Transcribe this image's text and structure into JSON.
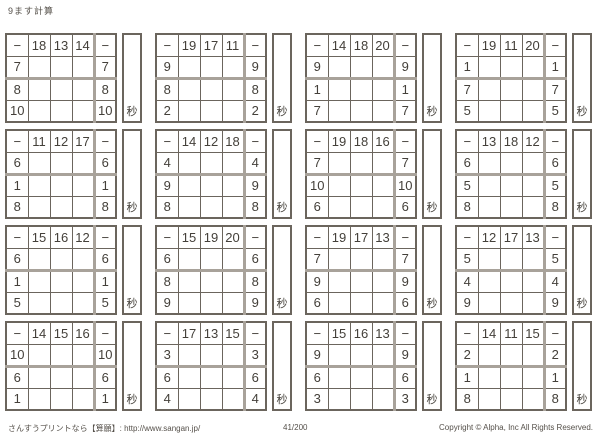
{
  "page": {
    "title": "9ます計算",
    "footer": {
      "site": "さんすうプリントなら【算願】: http://www.sangan.jp/",
      "page_number": "41/200",
      "copyright": "Copyright © Alpha, Inc All Rights Reserved."
    }
  },
  "worksheet": {
    "operator": "−",
    "seconds_label": "秒",
    "grids": [
      {
        "top": [
          "18",
          "13",
          "14"
        ],
        "left": [
          "7",
          "8",
          "10"
        ]
      },
      {
        "top": [
          "19",
          "17",
          "11"
        ],
        "left": [
          "9",
          "8",
          "2"
        ]
      },
      {
        "top": [
          "14",
          "18",
          "20"
        ],
        "left": [
          "9",
          "1",
          "7"
        ]
      },
      {
        "top": [
          "19",
          "11",
          "20"
        ],
        "left": [
          "1",
          "7",
          "5"
        ]
      },
      {
        "top": [
          "11",
          "12",
          "17"
        ],
        "left": [
          "6",
          "1",
          "8"
        ]
      },
      {
        "top": [
          "14",
          "12",
          "18"
        ],
        "left": [
          "4",
          "9",
          "8"
        ]
      },
      {
        "top": [
          "19",
          "18",
          "16"
        ],
        "left": [
          "7",
          "10",
          "6"
        ]
      },
      {
        "top": [
          "13",
          "18",
          "12"
        ],
        "left": [
          "6",
          "5",
          "8"
        ]
      },
      {
        "top": [
          "15",
          "16",
          "12"
        ],
        "left": [
          "6",
          "1",
          "5"
        ]
      },
      {
        "top": [
          "15",
          "19",
          "20"
        ],
        "left": [
          "6",
          "8",
          "9"
        ]
      },
      {
        "top": [
          "19",
          "17",
          "13"
        ],
        "left": [
          "7",
          "9",
          "6"
        ]
      },
      {
        "top": [
          "12",
          "17",
          "13"
        ],
        "left": [
          "5",
          "4",
          "9"
        ]
      },
      {
        "top": [
          "14",
          "15",
          "16"
        ],
        "left": [
          "10",
          "6",
          "1"
        ]
      },
      {
        "top": [
          "17",
          "13",
          "15"
        ],
        "left": [
          "3",
          "6",
          "4"
        ]
      },
      {
        "top": [
          "15",
          "16",
          "13"
        ],
        "left": [
          "9",
          "6",
          "3"
        ]
      },
      {
        "top": [
          "14",
          "11",
          "15"
        ],
        "left": [
          "2",
          "1",
          "8"
        ]
      }
    ]
  }
}
